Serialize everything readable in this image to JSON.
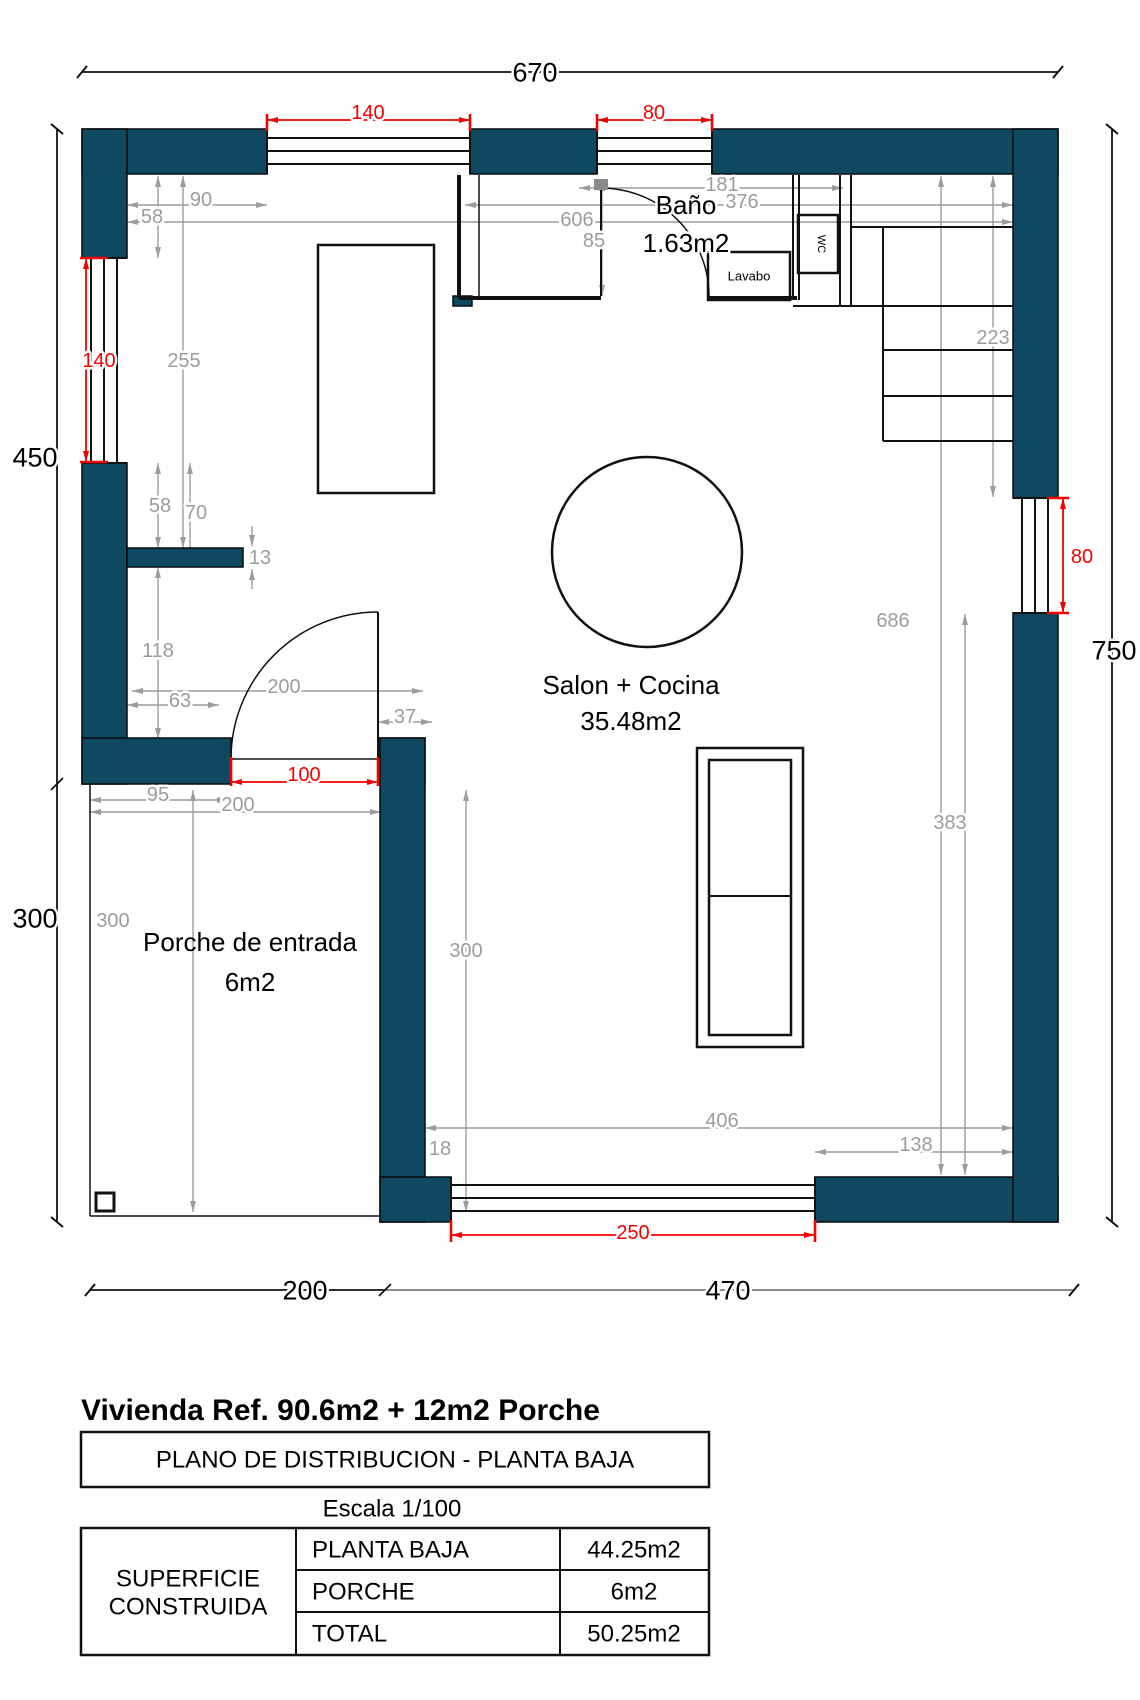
{
  "rooms": {
    "bano": {
      "name": "Baño",
      "area": "1.63m2"
    },
    "salon": {
      "name": "Salon + Cocina",
      "area": "35.48m2"
    },
    "porche": {
      "name": "Porche de entrada",
      "area": "6m2"
    }
  },
  "fixtures": {
    "wc": "WC",
    "lavabo": "Lavabo"
  },
  "overall": {
    "top": "670",
    "left_upper": "450",
    "left_lower": "300",
    "right": "750",
    "bottom_left": "200",
    "bottom_right": "470"
  },
  "red": {
    "top_w1": "140",
    "top_w2": "80",
    "left_w": "140",
    "door": "100",
    "right_w": "80",
    "bottom_w": "250"
  },
  "gray": {
    "g90": "90",
    "g58a": "58",
    "g255": "255",
    "g58b": "58",
    "g70": "70",
    "g13": "13",
    "g118": "118",
    "g63": "63",
    "g200a": "200",
    "g37": "37",
    "g95": "95",
    "g200b": "200",
    "g300a": "300",
    "g300b": "300",
    "g18": "18",
    "g406": "406",
    "g138": "138",
    "g686": "686",
    "g223": "223",
    "g383": "383",
    "g181": "181",
    "g376": "376",
    "g606": "606",
    "g85": "85"
  },
  "titleblock": {
    "heading": "Vivienda Ref. 90.6m2 + 12m2 Porche",
    "plan_box": "PLANO DE DISTRIBUCION - PLANTA BAJA",
    "scale": "Escala 1/100",
    "header1": "SUPERFICIE",
    "header2": "CONSTRUIDA",
    "rows": [
      {
        "label": "PLANTA BAJA",
        "value": "44.25m2"
      },
      {
        "label": "PORCHE",
        "value": "6m2"
      },
      {
        "label": "TOTAL",
        "value": "50.25m2"
      }
    ]
  },
  "colors": {
    "wall": "#0e4961",
    "dim_red": "#f40000",
    "dim_gray": "#9c9c9c",
    "line_black": "#111111"
  }
}
